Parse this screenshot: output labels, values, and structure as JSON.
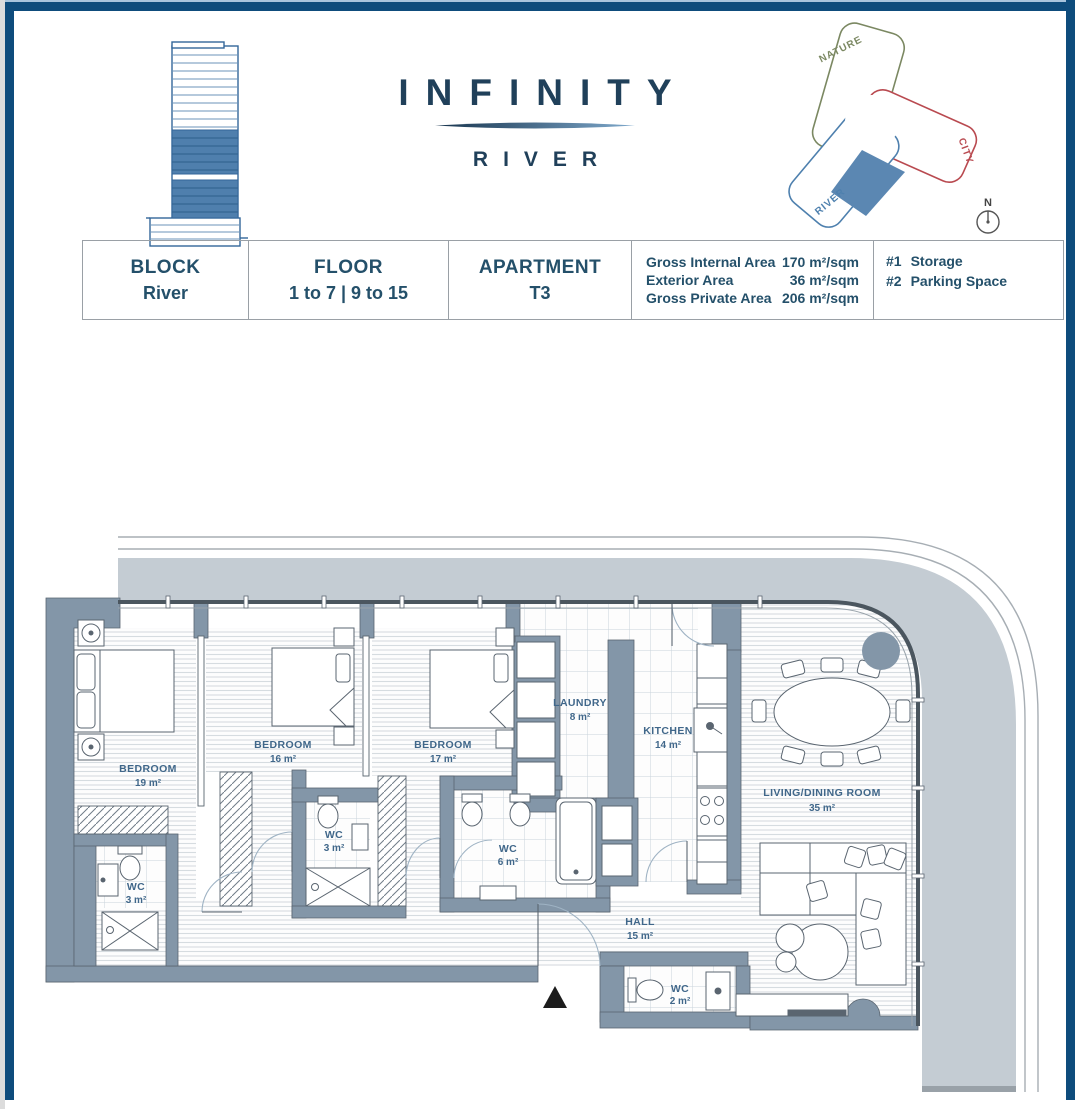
{
  "header": {
    "logo": {
      "title": "INFINITY",
      "subtitle": "RIVER"
    },
    "site_diagram": {
      "nature_label": "NATURE",
      "city_label": "CITY",
      "river_label": "RIVER",
      "compass_label": "N"
    }
  },
  "info_table": {
    "block": {
      "label": "BLOCK",
      "value": "River"
    },
    "floor": {
      "label": "FLOOR",
      "value": "1 to 7 | 9 to 15"
    },
    "apartment": {
      "label": "APARTMENT",
      "value": "T3"
    },
    "areas": [
      {
        "label": "Gross Internal Area",
        "value": "170 m²/sqm"
      },
      {
        "label": "Exterior Area",
        "value": "36 m²/sqm"
      },
      {
        "label": "Gross Private Area",
        "value": "206 m²/sqm"
      }
    ],
    "extras": [
      {
        "num": "#1",
        "label": "Storage"
      },
      {
        "num": "#2",
        "label": "Parking Space"
      }
    ]
  },
  "floor_plan": {
    "rooms": [
      {
        "name": "BEDROOM",
        "area": "19 m²"
      },
      {
        "name": "BEDROOM",
        "area": "16 m²"
      },
      {
        "name": "BEDROOM",
        "area": "17 m²"
      },
      {
        "name": "LAUNDRY",
        "area": "8 m²"
      },
      {
        "name": "KITCHEN",
        "area": "14 m²"
      },
      {
        "name": "LIVING/DINING ROOM",
        "area": "35 m²"
      },
      {
        "name": "WC",
        "area": "3 m²"
      },
      {
        "name": "WC",
        "area": "3 m²"
      },
      {
        "name": "WC",
        "area": "6 m²"
      },
      {
        "name": "HALL",
        "area": "15 m²"
      },
      {
        "name": "WC",
        "area": "2 m²"
      }
    ]
  },
  "colors": {
    "frame_navy": "#0e4c7c",
    "logo_navy": "#20405a",
    "steel_blue": "#4f7fad",
    "wall_gray": "#8396a8",
    "terrace_gray": "#c4ccd3",
    "label_blue": "#40678a",
    "nature_green": "#7b8862",
    "city_red": "#b94a50",
    "river_blue": "#4e80ae"
  }
}
